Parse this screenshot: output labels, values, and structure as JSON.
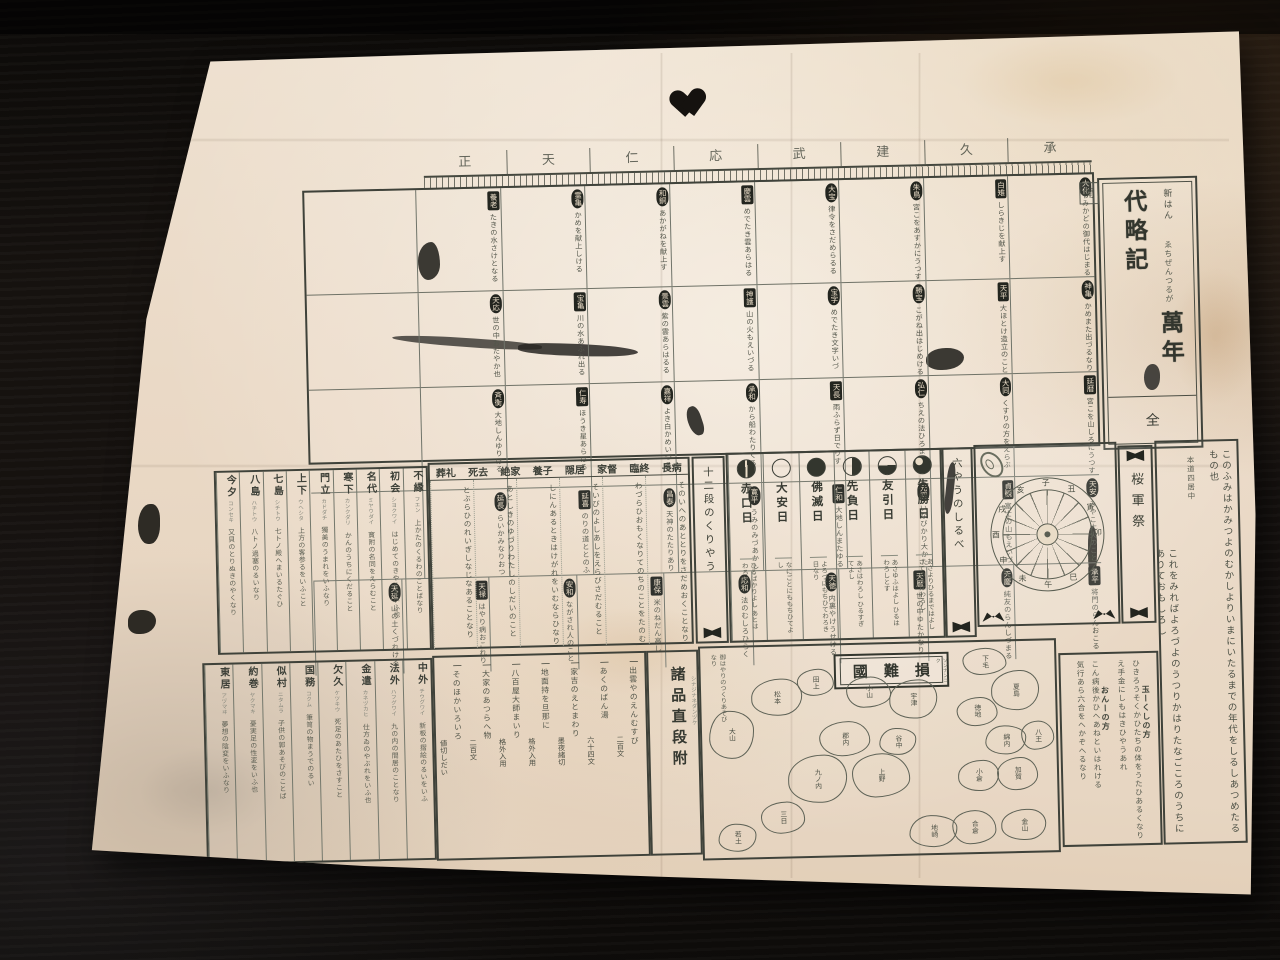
{
  "colors": {
    "paper": "#ead9c6",
    "ink": "#41453d",
    "seal_bg": "#23251f",
    "background": "#14110e"
  },
  "title_panel": {
    "corner_char": "開",
    "prefix": "新はん",
    "subtitle": "ゑちぜんつるが",
    "main": "萬年代略記",
    "volume": "全"
  },
  "header_band": {
    "chars": [
      "承",
      "久",
      "建",
      "武",
      "応",
      "仁",
      "天",
      "正"
    ]
  },
  "era_grid": {
    "rows": [
      [
        {
          "era": "大化",
          "shape": "oval",
          "note": "みかどの御代はじまる"
        },
        {
          "era": "白雉",
          "shape": "square",
          "note": "しらきじを献上す"
        },
        {
          "era": "朱鳥",
          "shape": "oval",
          "note": "宮こをあすかにうつす"
        },
        {
          "era": "大宝",
          "shape": "oval",
          "note": "律令をさだめらるる"
        },
        {
          "era": "慶雲",
          "shape": "square",
          "note": "めでたき雲あらはる"
        },
        {
          "era": "和銅",
          "shape": "oval",
          "note": "あかがねを献上す"
        },
        {
          "era": "霊亀",
          "shape": "oval",
          "note": "かめを献上しける"
        },
        {
          "era": "養老",
          "shape": "square",
          "note": "たきの水さけとなる"
        }
      ],
      [
        {
          "era": "神亀",
          "shape": "oval",
          "note": "かめまた出づるなり"
        },
        {
          "era": "天平",
          "shape": "square",
          "note": "大ほとけ造立のこと"
        },
        {
          "era": "勝宝",
          "shape": "oval",
          "note": "こがね出はじめける"
        },
        {
          "era": "宝字",
          "shape": "oval",
          "note": "めでたき文字いづ"
        },
        {
          "era": "神護",
          "shape": "square",
          "note": "山の火もえいづる"
        },
        {
          "era": "景雲",
          "shape": "oval",
          "note": "紫の雲あらはるる"
        },
        {
          "era": "宝亀",
          "shape": "square",
          "note": "川の水あふれ出る"
        },
        {
          "era": "天応",
          "shape": "oval",
          "note": "世の中おだやか也"
        }
      ],
      [
        {
          "era": "延暦",
          "shape": "square",
          "note": "宮こを山しろにうつす"
        },
        {
          "era": "大同",
          "shape": "oval",
          "note": "くすりの方をえらぶ"
        },
        {
          "era": "弘仁",
          "shape": "oval",
          "note": "ちえの法ひろまる"
        },
        {
          "era": "天長",
          "shape": "square",
          "note": "雨ふらず日でりす"
        },
        {
          "era": "承和",
          "shape": "oval",
          "note": "から船わたりくる"
        },
        {
          "era": "嘉祥",
          "shape": "oval",
          "note": "よき白かめいづる"
        },
        {
          "era": "仁寿",
          "shape": "square",
          "note": "ほうき星あらはる"
        },
        {
          "era": "斉衡",
          "shape": "oval",
          "note": "大地しんゆりける"
        }
      ],
      [
        {
          "era": "天安",
          "shape": "oval",
          "note": "みやこ大火のこと"
        },
        {
          "era": "貞観",
          "shape": "square",
          "note": "富士の山もえいづ"
        },
        {
          "era": "元慶",
          "shape": "oval",
          "note": "いなびかり大かた"
        },
        {
          "era": "仁和",
          "shape": "square",
          "note": "大地しんまたゆる"
        },
        {
          "era": "寛平",
          "shape": "oval",
          "note": "うみのみづあかし"
        },
        {
          "era": "昌泰",
          "shape": "oval",
          "note": "天神のたたりあり"
        },
        {
          "era": "延喜",
          "shape": "square",
          "note": "のりの道ととのふ"
        },
        {
          "era": "延長",
          "shape": "oval",
          "note": "らいかみなりおつ"
        }
      ],
      [
        {
          "era": "承平",
          "shape": "square",
          "note": "将門のらんおこる"
        },
        {
          "era": "天慶",
          "shape": "oval",
          "note": "純友のらんしづまる"
        },
        {
          "era": "天暦",
          "shape": "square",
          "note": "世の中ゆたかなり"
        },
        {
          "era": "天徳",
          "shape": "oval",
          "note": "内裏やけうせける"
        },
        {
          "era": "応和",
          "shape": "oval",
          "note": "法のむしろひらく"
        },
        {
          "era": "康保",
          "shape": "square",
          "note": "米のねだん高し"
        },
        {
          "era": "安和",
          "shape": "oval",
          "note": "ながされ人のこと"
        },
        {
          "era": "天禄",
          "shape": "square",
          "note": "はやり病おこれり"
        },
        {
          "era": "天延",
          "shape": "oval",
          "note": "山の土くづれける"
        }
      ]
    ]
  },
  "glossary_top": {
    "columns": [
      {
        "head": "不縁",
        "gloss": "フエン",
        "body": "上かたのくるわのことばなり"
      },
      {
        "head": "初会",
        "gloss": "シヨクワイ",
        "body": "はじめてのきやくをいふ也"
      },
      {
        "head": "名代",
        "gloss": "ミヤウダイ",
        "body": "寳附の名同をえらむこと"
      },
      {
        "head": "寒下",
        "gloss": "カンクダリ",
        "body": "かんのうちにくだること"
      },
      {
        "head": "門立",
        "gloss": "カドダチ",
        "body": "獨美のうまれをいふなり"
      },
      {
        "head": "上下",
        "gloss": "ウヘシタ",
        "body": "上方の客参るをいふこと"
      },
      {
        "head": "七島",
        "gloss": "シチトウ",
        "body": "七トノ殿へまいるたぐひ"
      },
      {
        "head": "八島",
        "gloss": "ハチトウ",
        "body": "八トノ過塞のるいなり"
      },
      {
        "head": "今夕",
        "gloss": "コンセキ",
        "body": "又貝のとりぬきのやくなり"
      }
    ]
  },
  "terms_block": {
    "terms": [
      "長病",
      "臨終",
      "家督",
      "隠居",
      "養子",
      "絶家",
      "死去",
      "葬礼"
    ],
    "columns": [
      "そのいへのあととりをさだめおくことなり",
      "わづらひおもくなりてのちのことをたのむ",
      "そいびのよしあしをえらびさだむること",
      "しにんあるときはけがれをいむならひなり",
      "あとしきのゆづりわたしのしだいのこと",
      "とぶらひのれいぎしなじなあることなり"
    ]
  },
  "junidan_label": "十二段のくりやう",
  "rokuyo": {
    "guide_label": "六やうのしるべ",
    "days": [
      {
        "name": "先勝日",
        "symbol": "three-quarters",
        "desc": "あさよりひるまではよし さてのちはわろし"
      },
      {
        "name": "友引日",
        "symbol": "bottom-half",
        "desc": "あさゆふはよし ひるはわろしとす"
      },
      {
        "name": "先負日",
        "symbol": "right-half",
        "desc": "あさはわろし ひるすぎてよし"
      },
      {
        "name": "佛滅日",
        "symbol": "full",
        "desc": "よろづにもちひてわろき日なり"
      },
      {
        "name": "大安日",
        "symbol": "open",
        "desc": "なにごとにももちひてよし"
      },
      {
        "name": "赤口日",
        "symbol": "full-slit",
        "desc": "ひるばかりよし あとはわろし"
      }
    ]
  },
  "wheel": {
    "branches": [
      "子",
      "丑",
      "寅",
      "卯",
      "辰",
      "巳",
      "午",
      "未",
      "申",
      "酉",
      "戌",
      "亥"
    ]
  },
  "gunsai_label": "桜軍祭",
  "right_column": {
    "lines": [
      "このふみはかみつよのむかしよりいまにいたるまでの年代をしるしあつめたるもの也",
      "本道四居中",
      "これをみればよろづよのうつりかはりたなごころのうちにありておもしろし"
    ]
  },
  "glossary_bottom": {
    "columns": [
      {
        "head": "中外",
        "gloss": "チウグワイ",
        "body": "新板の摺絵のるいをいふ"
      },
      {
        "head": "法外",
        "gloss": "ハフグワイ",
        "body": "九の内の間居のことなり"
      },
      {
        "head": "金遣",
        "gloss": "カネヅカヒ",
        "body": "仕方ゐのやぶれをいふ也"
      },
      {
        "head": "欠久",
        "gloss": "ケツキウ",
        "body": "死足のあたひをさすこと"
      },
      {
        "head": "国務",
        "gloss": "コクム",
        "body": "筆笥の物まうでのるい"
      },
      {
        "head": "似村",
        "gloss": "ニタムラ",
        "body": "子供の郭あそびのことば"
      },
      {
        "head": "約巻",
        "gloss": "ヤクマキ",
        "body": "憂実足の性変をいふ也"
      },
      {
        "head": "東居",
        "gloss": "アヅマヰ",
        "body": "夢想の陰変をいふなり"
      }
    ]
  },
  "price_list": {
    "label": "諸品直段附",
    "gloss": "シナジナネダンヅケ",
    "marker": "一",
    "items": [
      {
        "item": "出雲やのえんむすび",
        "price": "二百文"
      },
      {
        "item": "あくのばん湯",
        "price": "六十四文"
      },
      {
        "item": "家吉のえとまわり",
        "price": "墨夜緒切"
      },
      {
        "item": "地面持を旦那に",
        "price": "格外入用"
      },
      {
        "item": "八百屋大師まいり",
        "price": "格外入用"
      },
      {
        "item": "大家のあつらへ物",
        "price": "二百文"
      },
      {
        "item": "そのほかいろいろ",
        "price": "値切しだい"
      }
    ]
  },
  "map": {
    "title": "損難國",
    "furigana": "ソンナンコク",
    "note": "御はやりのつくりあそびなり",
    "provinces": [
      {
        "label": "松本",
        "x": 14,
        "y": 15,
        "w": 14,
        "h": 17
      },
      {
        "label": "田上",
        "x": 27,
        "y": 11,
        "w": 10,
        "h": 12
      },
      {
        "label": "大山",
        "x": 2,
        "y": 30,
        "w": 12,
        "h": 22
      },
      {
        "label": "小山",
        "x": 41,
        "y": 15,
        "w": 12,
        "h": 14
      },
      {
        "label": "宇津",
        "x": 53,
        "y": 17,
        "w": 13,
        "h": 18
      },
      {
        "label": "郡内",
        "x": 33,
        "y": 36,
        "w": 14,
        "h": 16
      },
      {
        "label": "谷中",
        "x": 50,
        "y": 40,
        "w": 10,
        "h": 12
      },
      {
        "label": "上野",
        "x": 42,
        "y": 52,
        "w": 16,
        "h": 20
      },
      {
        "label": "九ノ内",
        "x": 24,
        "y": 52,
        "w": 16,
        "h": 22
      },
      {
        "label": "三日",
        "x": 16,
        "y": 74,
        "w": 12,
        "h": 14
      },
      {
        "label": "若土",
        "x": 4,
        "y": 84,
        "w": 10,
        "h": 12
      },
      {
        "label": "下毛",
        "x": 74,
        "y": 3,
        "w": 12,
        "h": 12
      },
      {
        "label": "夏島",
        "x": 82,
        "y": 14,
        "w": 13,
        "h": 18
      },
      {
        "label": "徳地",
        "x": 72,
        "y": 26,
        "w": 11,
        "h": 13
      },
      {
        "label": "綿内",
        "x": 80,
        "y": 40,
        "w": 11,
        "h": 13
      },
      {
        "label": "八王",
        "x": 90,
        "y": 38,
        "w": 9,
        "h": 13
      },
      {
        "label": "小倉",
        "x": 72,
        "y": 56,
        "w": 11,
        "h": 14
      },
      {
        "label": "加賀",
        "x": 83,
        "y": 55,
        "w": 11,
        "h": 15
      },
      {
        "label": "地崎",
        "x": 58,
        "y": 82,
        "w": 13,
        "h": 14
      },
      {
        "label": "合倉",
        "x": 70,
        "y": 80,
        "w": 12,
        "h": 15
      },
      {
        "label": "金山",
        "x": 84,
        "y": 80,
        "w": 12,
        "h": 14
      }
    ]
  },
  "side_notes": {
    "sections": [
      {
        "head": "玉ーくしの方",
        "lines": [
          "ひきろうそくかひたちの体をうたひあるくなり",
          "え手金にしもはきひやうあれ"
        ]
      },
      {
        "head": "おんーの方",
        "lines": [
          "こん病後かひへあねといはれける",
          "気行あら六合をへかぞへるなり"
        ]
      }
    ]
  }
}
